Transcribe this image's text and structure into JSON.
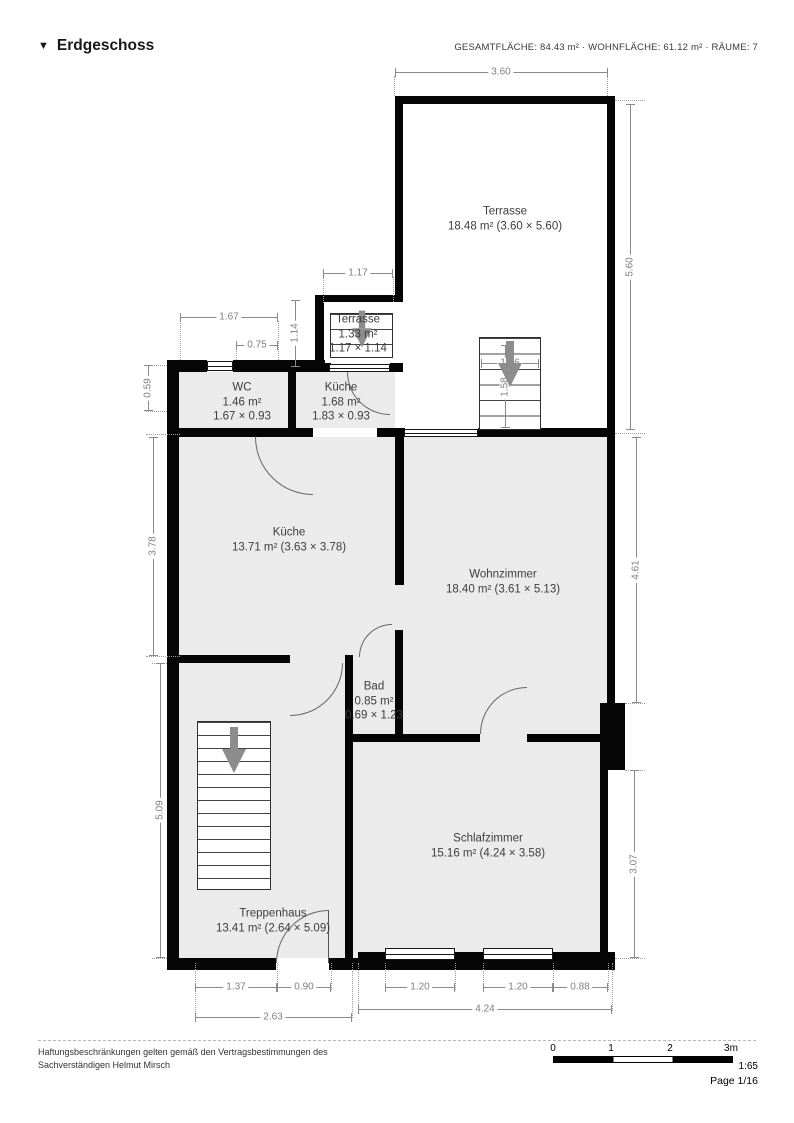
{
  "header": {
    "marker": "▼",
    "title": "Erdgeschoss",
    "stats": "GESAMTFLÄCHE: 84.43 m² · WOHNFLÄCHE: 61.12 m² · RÄUME: 7"
  },
  "rooms": [
    {
      "name": "Terrasse",
      "area": "18.48 m² (3.60 × 5.60)"
    },
    {
      "name": "Terrasse",
      "area": "1.33 m²",
      "size": "1.17 × 1.14"
    },
    {
      "name": "WC",
      "area": "1.46 m²",
      "size": "1.67 × 0.93"
    },
    {
      "name": "Küche",
      "area": "1.68 m²",
      "size": "1.83 × 0.93"
    },
    {
      "name": "Küche",
      "area": "13.71 m² (3.63 × 3.78)"
    },
    {
      "name": "Wohnzimmer",
      "area": "18.40 m² (3.61 × 5.13)"
    },
    {
      "name": "Bad",
      "area": "0.85 m²",
      "size": "0.69 × 1.23"
    },
    {
      "name": "Schlafzimmer",
      "area": "15.16 m² (4.24 × 3.58)"
    },
    {
      "name": "Treppenhaus",
      "area": "13.41 m² (2.64 × 5.09)"
    }
  ],
  "dims": {
    "top": "3.60",
    "terrace_right": "5.60",
    "nook_w": "1.17",
    "wc_w": "1.67",
    "wc_part": "0.75",
    "nook_h": "1.14",
    "stair_w": "1.06",
    "stair_h": "1.58",
    "left_small": "0.59",
    "kueche_h": "3.78",
    "wohn_right": "4.61",
    "trepp_h": "5.09",
    "schlaf_right": "3.07",
    "trepp_w1": "1.37",
    "door_w": "0.90",
    "trepp_total": "2.63",
    "win1": "1.20",
    "win2": "1.20",
    "wall_r": "0.88",
    "schlaf_total": "4.24"
  },
  "footer": {
    "line1": "Haftungsbeschränkungen gelten gemäß den Vertragsbestimmungen des",
    "line2": "Sachverständigen Helmut Mirsch"
  },
  "scalebar": {
    "t0": "0",
    "t1": "1",
    "t2": "2",
    "t3": "3m",
    "ratio": "1:65",
    "page": "Page 1/16"
  }
}
